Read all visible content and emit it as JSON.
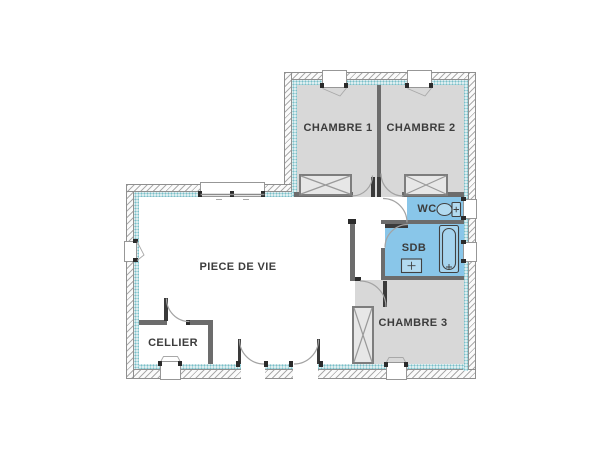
{
  "plan": {
    "type": "floor-plan",
    "rooms": [
      {
        "id": "chambre1",
        "label": "CHAMBRE 1"
      },
      {
        "id": "chambre2",
        "label": "CHAMBRE 2"
      },
      {
        "id": "wc",
        "label": "WC"
      },
      {
        "id": "sdb",
        "label": "SDB"
      },
      {
        "id": "chambre3",
        "label": "CHAMBRE 3"
      },
      {
        "id": "piece_de_vie",
        "label": "PIECE DE VIE"
      },
      {
        "id": "cellier",
        "label": "CELLIER"
      }
    ],
    "fixtures": [
      {
        "icon": "toilet-icon",
        "room": "WC"
      },
      {
        "icon": "sink-icon",
        "room": "SDB"
      },
      {
        "icon": "bathtub-icon",
        "room": "SDB"
      },
      {
        "icon": "closet-x-icon",
        "room": "CHAMBRE 1"
      },
      {
        "icon": "closet-x-icon",
        "room": "CHAMBRE 2"
      },
      {
        "icon": "closet-x-icon",
        "room": "CHAMBRE 3"
      }
    ],
    "colors": {
      "wet_room_fill": "#89c6e9",
      "bedroom_fill": "#d8d8d8",
      "insulation_band": "#ddeef0",
      "partition_wall": "#6c6c6c",
      "label_text": "#3c3c3c"
    }
  }
}
